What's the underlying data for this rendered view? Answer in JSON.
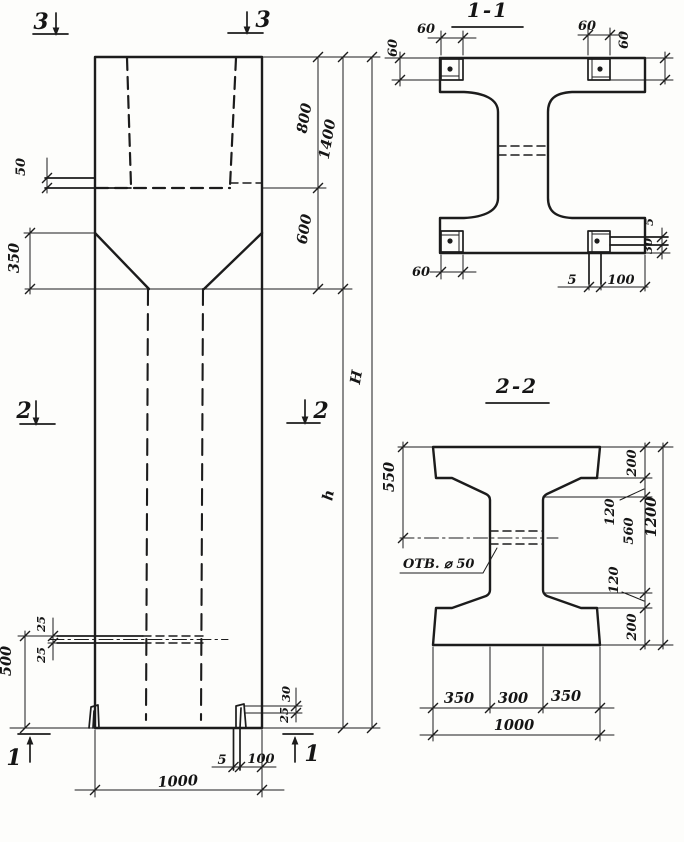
{
  "elevation": {
    "markers": {
      "top_left": "3",
      "top_right": "3",
      "mid_left": "2",
      "mid_right": "2",
      "bottom_left": "1",
      "bottom_right": "1"
    },
    "dims": {
      "ledge": "50",
      "taper": "350",
      "top_segment": "800",
      "middle_segment": "600",
      "top_total": "1400",
      "full_height": "H",
      "shaft_height": "h",
      "hole_above": "25",
      "hole_below": "25",
      "hole_level": "500",
      "foot_upper": "30",
      "foot_lower": "25",
      "base_plate_thickness": "5",
      "base_plate_offset": "100",
      "column_width": "1000"
    }
  },
  "section_1_1": {
    "title": "1-1",
    "dims": {
      "plate_top_left": "60",
      "plate_side_left": "60",
      "plate_top_right": "60",
      "plate_side_right": "60",
      "plate_bottom_left": "60",
      "lug_thickness": "5",
      "lug_offset": "30",
      "strip_thickness": "5",
      "strip_offset": "100"
    }
  },
  "section_2_2": {
    "title": "2-2",
    "hole_label": "ОТВ. ⌀ 50",
    "dims": {
      "flange_to_hole": "550",
      "top_flange": "200",
      "haunch_upper": "120",
      "web_height": "560",
      "haunch_lower": "120",
      "bottom_flange": "200",
      "section_depth": "1200",
      "bottom_left": "350",
      "bottom_web": "300",
      "bottom_right": "350",
      "section_width": "1000"
    }
  }
}
